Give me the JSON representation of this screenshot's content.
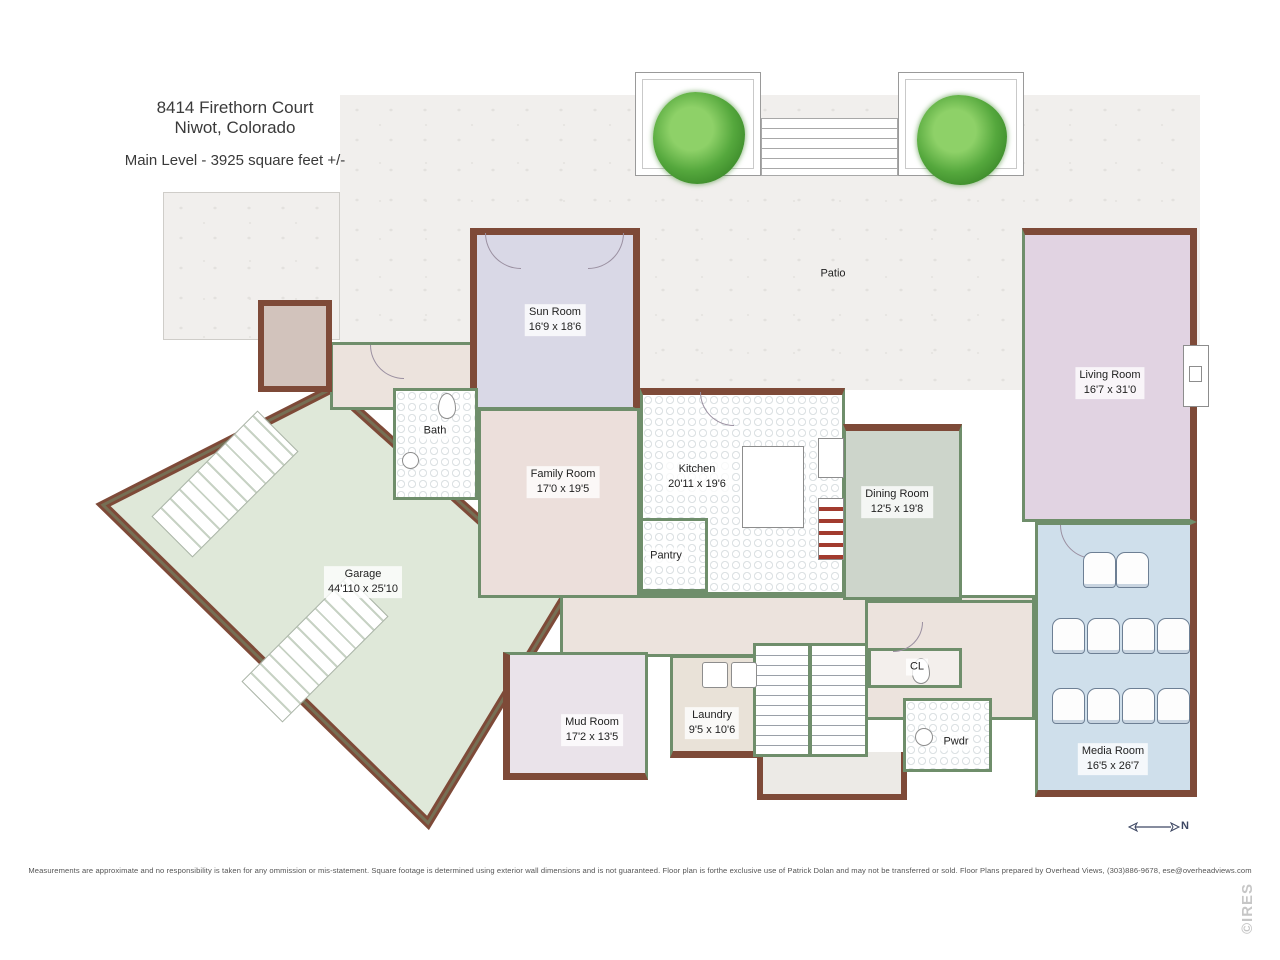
{
  "header": {
    "address_line1": "8414 Firethorn Court",
    "address_line2": "Niwot, Colorado",
    "level_info": "Main Level - 3925 square feet +/-"
  },
  "rooms": {
    "patio": {
      "name": "Patio"
    },
    "sun_room": {
      "name": "Sun Room",
      "dims": "16'9 x 18'6"
    },
    "living_room": {
      "name": "Living Room",
      "dims": "16'7 x 31'0"
    },
    "bath": {
      "name": "Bath"
    },
    "family_room": {
      "name": "Family Room",
      "dims": "17'0 x 19'5"
    },
    "kitchen": {
      "name": "Kitchen",
      "dims": "20'11 x 19'6"
    },
    "dining_room": {
      "name": "Dining Room",
      "dims": "12'5 x 19'8"
    },
    "garage": {
      "name": "Garage",
      "dims": "44'110 x 25'10"
    },
    "pantry": {
      "name": "Pantry"
    },
    "mud_room": {
      "name": "Mud Room",
      "dims": "17'2 x 13'5"
    },
    "laundry": {
      "name": "Laundry",
      "dims": "9'5 x 10'6"
    },
    "closet": {
      "name": "CL"
    },
    "powder": {
      "name": "Pwdr"
    },
    "media_room": {
      "name": "Media Room",
      "dims": "16'5 x 26'7"
    }
  },
  "compass": {
    "label": "N"
  },
  "footer": {
    "disclaimer": "Measurements  are approximate and no responsibility is taken for any ommission or mis-statement.   Square footage is determined using exterior wall dimensions and is not guaranteed.   Floor plan is forthe exclusive use of  Patrick Dolan and may not be transferred or sold. Floor Plans prepared by Overhead Views, (303)886-9678, ese@overheadviews.com",
    "watermark": "©IRES"
  },
  "colors": {
    "wall_exterior": "#7e4a38",
    "wall_interior": "#6f8e6b",
    "garage_fill": "#dfe8d9",
    "sun_room_fill": "#d9d8e6",
    "living_room_fill": "#e1d3e2",
    "family_room_fill": "#ecdfdb",
    "dining_room_fill": "#cdd5cb",
    "media_room_fill": "#cfdfeb",
    "mud_room_fill": "#eae3ea",
    "laundry_fill": "#e9e2d8",
    "hall_fill": "#ece3dd",
    "patio_fill": "#f1efed",
    "tree_green": "#55a83d"
  }
}
